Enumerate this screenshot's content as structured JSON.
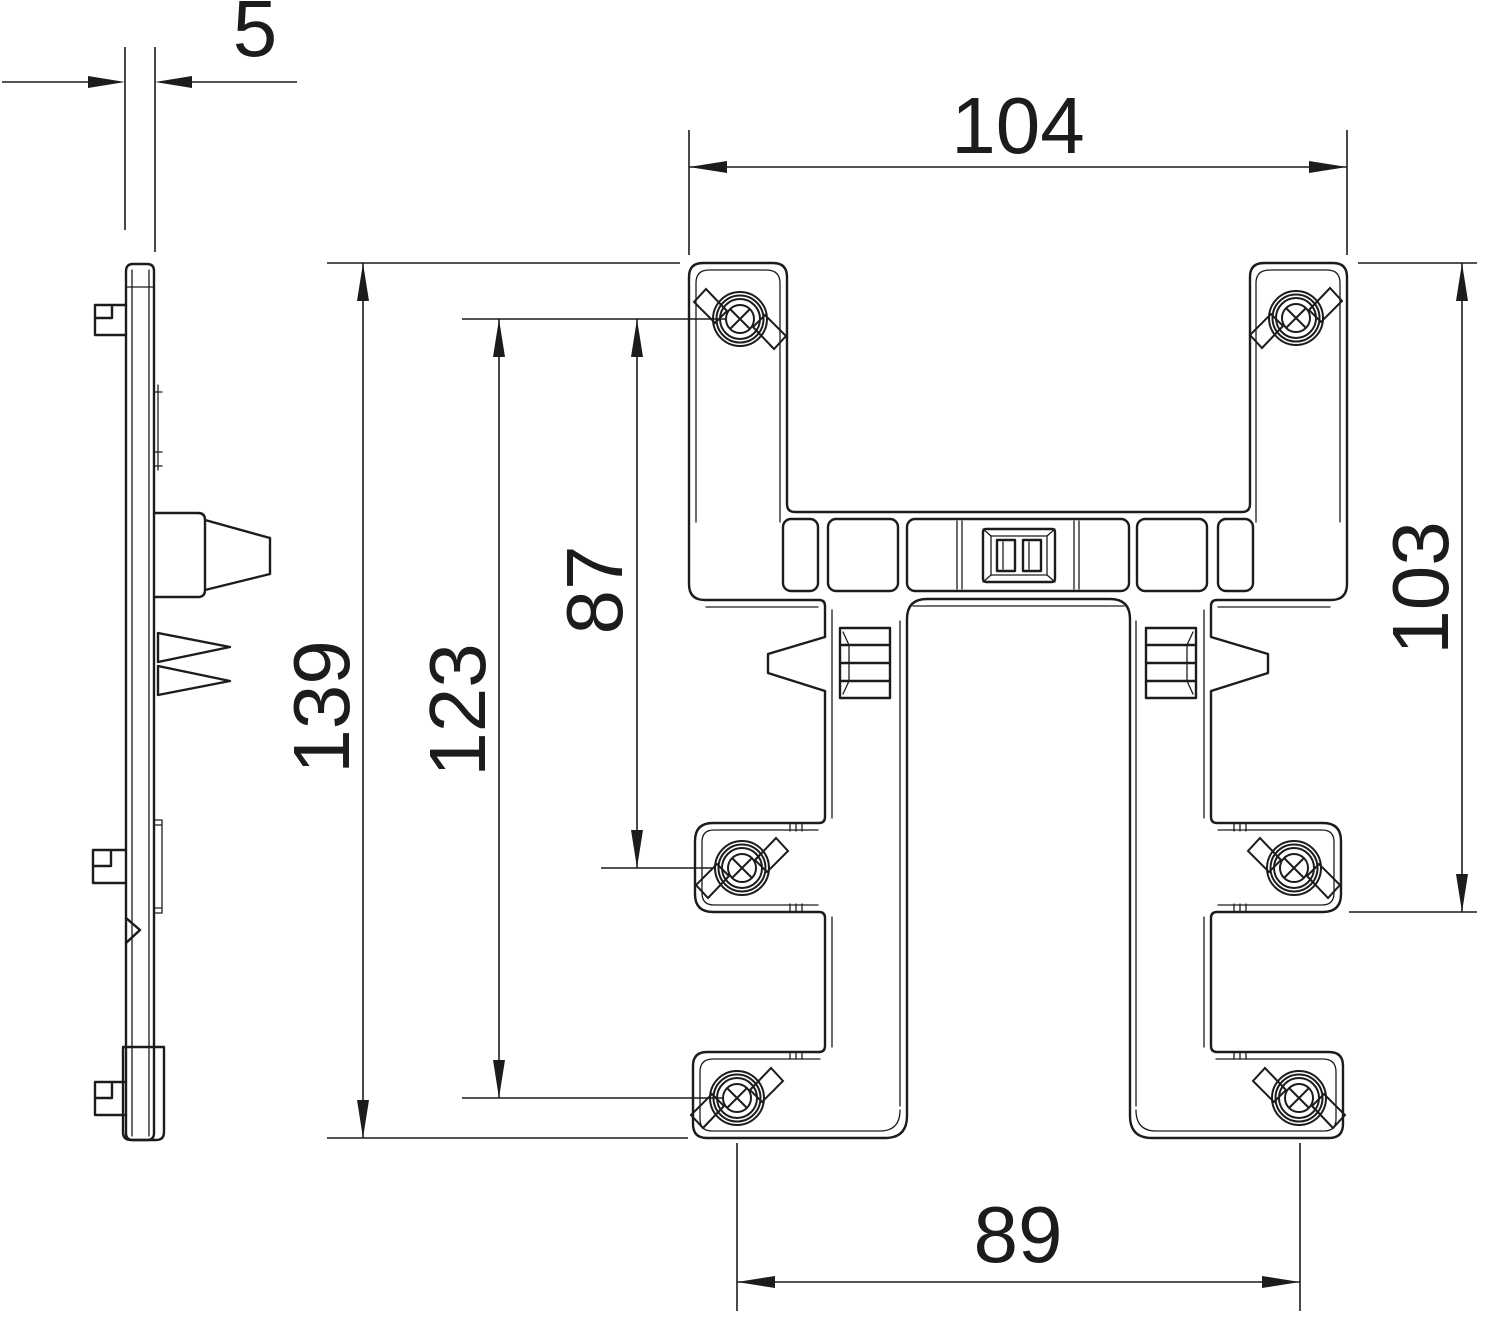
{
  "drawing": {
    "type": "technical-dimension-drawing",
    "part": "mounting bracket, side profile and front view",
    "colors": {
      "line": "#1c1c1c",
      "background": "#ffffff"
    },
    "views": {
      "side": "side profile view",
      "front": "front view"
    },
    "dimensions": {
      "thickness": "5",
      "top_width": "104",
      "overall_height": "139",
      "hole_span_outer": "123",
      "hole_span_upper": "87",
      "right_height": "103",
      "hole_span_bottom": "89"
    }
  }
}
